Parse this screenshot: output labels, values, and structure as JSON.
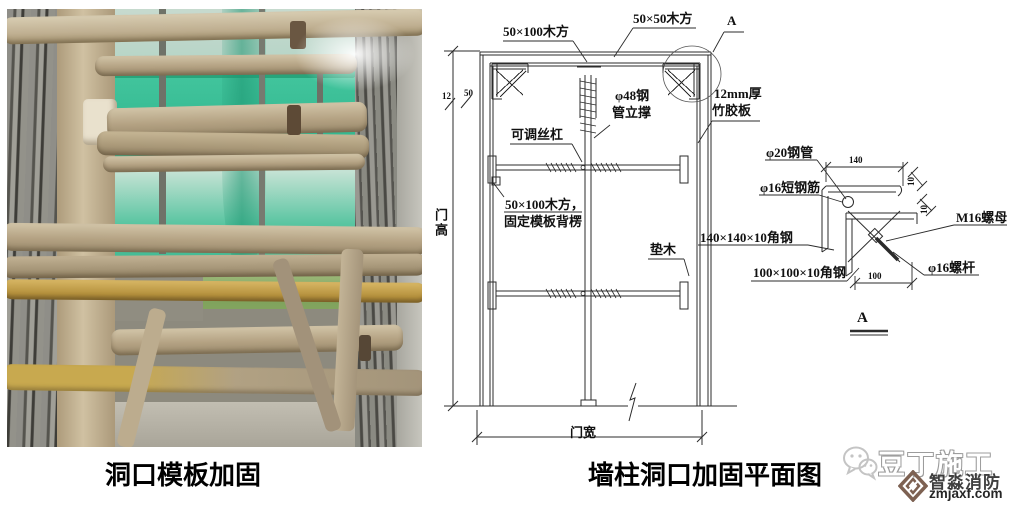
{
  "captions": {
    "photo": "洞口模板加固",
    "diagram": "墙柱洞口加固平面图"
  },
  "diagram": {
    "labels": {
      "wood_50x100": "50×100木方",
      "wood_50x50": "50×50木方",
      "detail_mark": "A",
      "pipe48_l1": "φ48钢",
      "pipe48_l2": "管立撑",
      "adjustable_screw": "可调丝杠",
      "plywood_l1": "12mm厚",
      "plywood_l2": "竹胶板",
      "wood_fix_l1": "50×100木方，",
      "wood_fix_l2": "固定模板背楞",
      "pad_wood": "垫木",
      "door_height": "门高",
      "door_width": "门宽",
      "dim_12": "12",
      "dim_50": "50"
    },
    "detail_a": {
      "title": "A",
      "pipe20": "φ20钢管",
      "short_bar": "φ16短钢筋",
      "angle_140": "140×140×10角钢",
      "angle_100": "100×100×10角钢",
      "nut": "M16螺母",
      "rod": "φ16螺杆",
      "dim_140": "140",
      "dim_100": "100",
      "dim_10_top": "10",
      "dim_10_mid": "10"
    }
  },
  "watermark": {
    "brand": "豆丁施工",
    "company": "智淼消防",
    "site": "zmjaxf.com"
  },
  "colors": {
    "line": "#2b2b2b",
    "net_green": "#35bb92",
    "brand_brown": "#7d6152"
  }
}
